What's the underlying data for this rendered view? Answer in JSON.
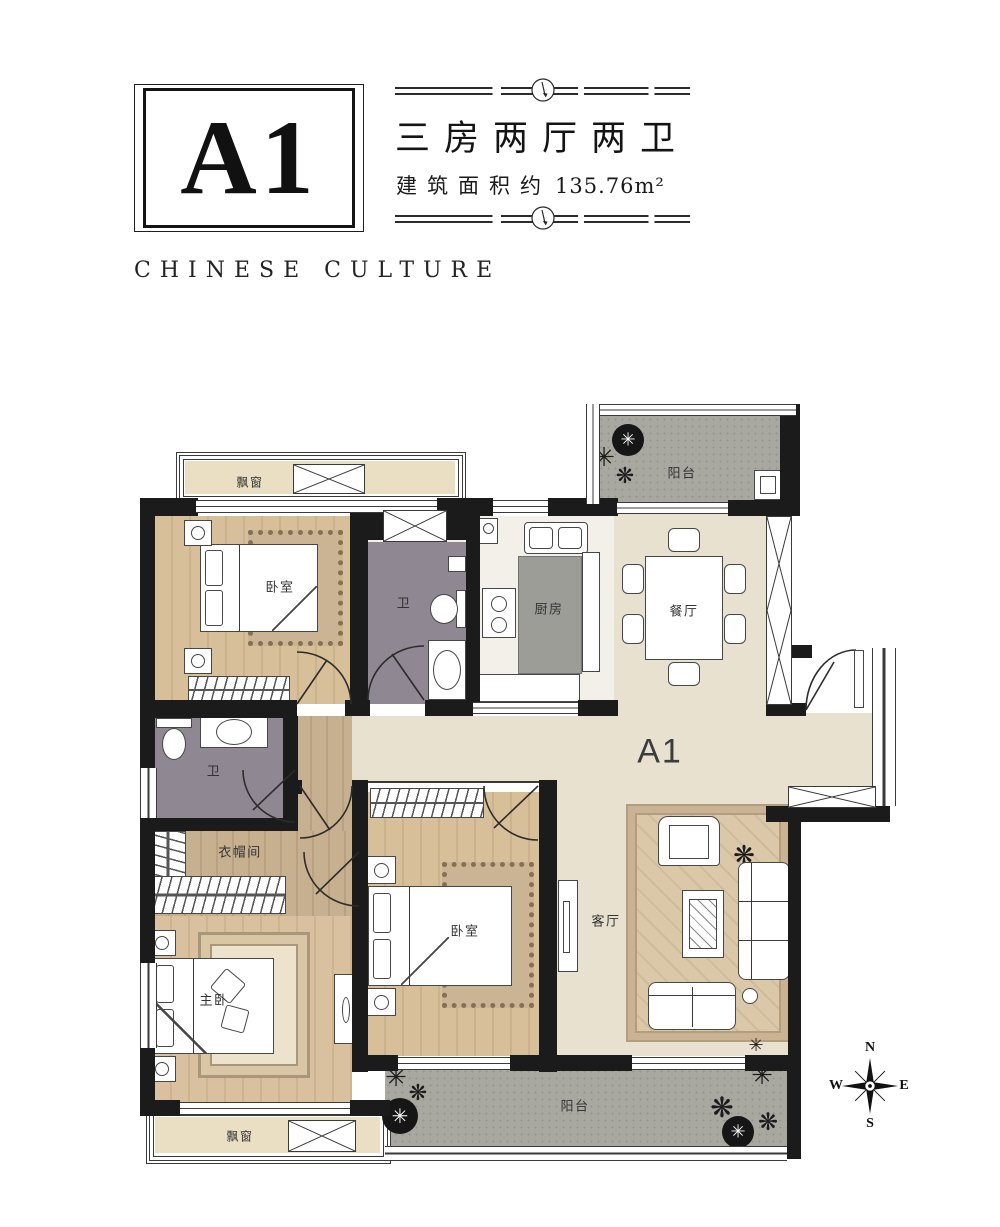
{
  "header": {
    "unit": "A1",
    "title": "三房两厅两卫",
    "area_label": "建筑面积约",
    "area_value": "135.76m²",
    "subtitle": "CHINESE CULTURE"
  },
  "plan": {
    "unit_label": "A1",
    "rooms": {
      "bay_window_top": "飘窗",
      "bedroom_top": "卧室",
      "bath_top": "卫",
      "kitchen": "厨房",
      "dining": "餐厅",
      "balcony_top": "阳台",
      "bath_mid": "卫",
      "cloakroom": "衣帽间",
      "master_bedroom": "主卧",
      "bedroom_mid": "卧室",
      "living": "客厅",
      "balcony_bottom": "阳台",
      "bay_window_bottom": "飘窗"
    },
    "compass": {
      "north": "N",
      "south": "S",
      "east": "E",
      "west": "W"
    }
  },
  "colors": {
    "wall": "#1b1b1b",
    "wood_floor": "#d7bf9a",
    "open_area_floor": "#e9e1d0",
    "bath_floor": "#8f8792",
    "balcony_floor": "#a8a7a0",
    "counter": "#9d9d97",
    "bay_sill": "#eadfc2",
    "text": "#333333"
  }
}
